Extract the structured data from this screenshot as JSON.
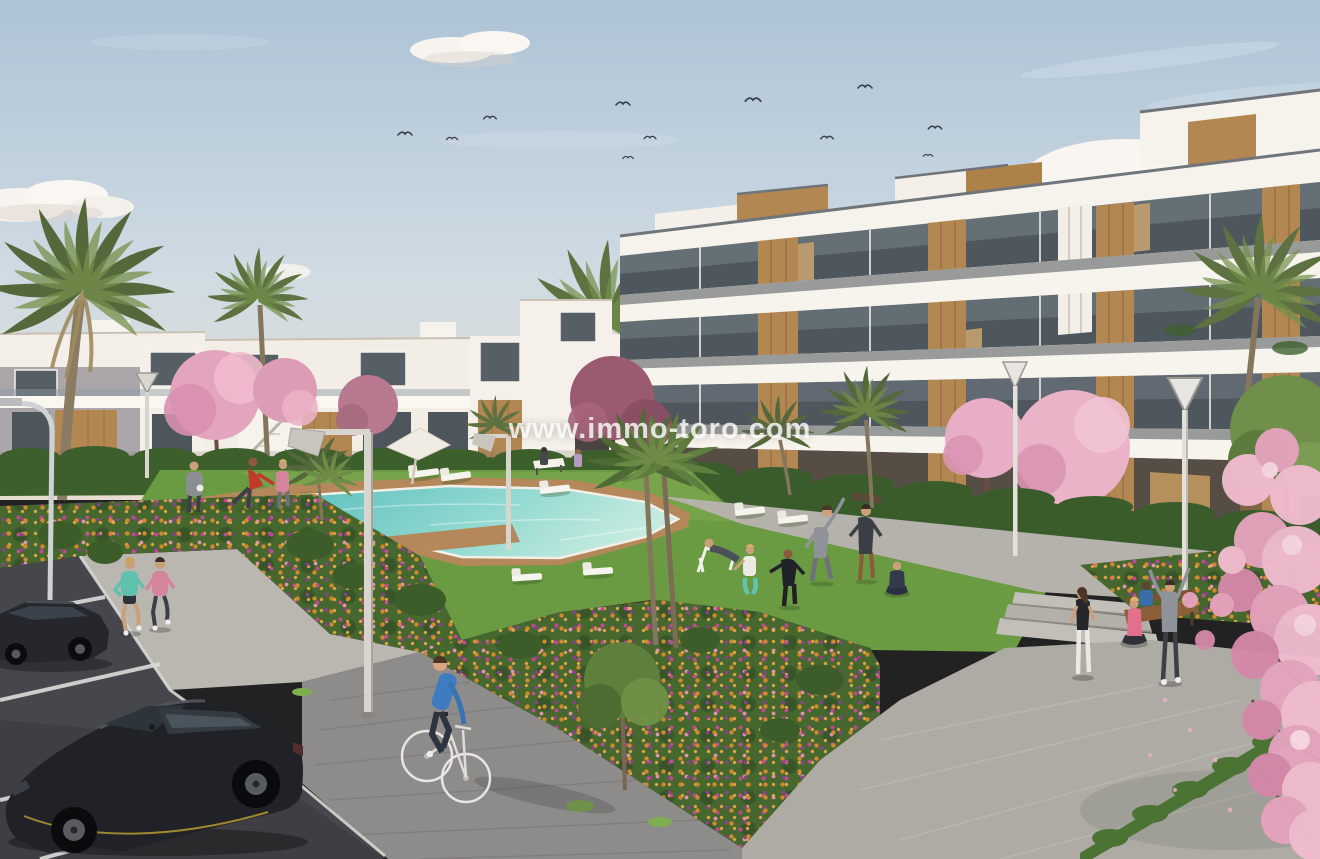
{
  "meta": {
    "type": "architectural-rendering",
    "subject": "New-build residential complex with communal pool, gardens and parking",
    "width": 1320,
    "height": 859
  },
  "watermark": {
    "text": "www.immo-toro.com",
    "color": "#ffffff",
    "opacity": 0.8
  },
  "palette": {
    "sky_top": "#adc3d6",
    "sky_horizon": "#e7ddd1",
    "cloud": "#f7f4f0",
    "building_white": "#f4f0e9",
    "building_shadow": "#d9d0c3",
    "wood_accent": "#b28751",
    "glass_dark": "#4e565e",
    "grass": "#6a9a42",
    "hedge": "#3d5f2c",
    "pool_water": "#7fd2cb",
    "pool_water_light": "#c6ebe0",
    "deck_wood": "#b4885a",
    "path_light": "#b6b3ad",
    "paver_dark": "#8e8b8b",
    "asphalt": "#46474c",
    "flower_orange": "#d3892e",
    "flower_magenta": "#c14a92",
    "flower_purple": "#8c3f95",
    "blossom_pink": "#eeb4ca",
    "car_black": "#212227",
    "shirt_blue": "#3d7cc0",
    "shirt_teal": "#5fc0ad",
    "shirt_pink": "#d4849c",
    "shirt_red": "#c0392b"
  },
  "scene": {
    "sky": {
      "elements": [
        "gradient sky",
        "clouds",
        "flock of birds"
      ],
      "bird_count": 11
    },
    "buildings": [
      {
        "name": "left terraced apartments",
        "floors": 2,
        "features": [
          "white facades",
          "wood panels",
          "external staircase",
          "arched doorway"
        ]
      },
      {
        "name": "right apartment block",
        "floors": 4,
        "features": [
          "sweeping white balconies",
          "wood panel accents",
          "glass railings",
          "rooftop volumes"
        ]
      }
    ],
    "pool": {
      "shape": "rectangular with side extension and cross deck",
      "deck": "wooden",
      "loungers": 9,
      "umbrellas": 1
    },
    "people": [
      {
        "label": "man stretching in red shirt",
        "x": 250,
        "y": 505
      },
      {
        "label": "man in gray with towel",
        "x": 195,
        "y": 510
      },
      {
        "label": "woman walking in pink top",
        "x": 283,
        "y": 508
      },
      {
        "label": "jogger woman in teal",
        "x": 131,
        "y": 632
      },
      {
        "label": "jogger woman in pink",
        "x": 160,
        "y": 630
      },
      {
        "label": "man reclining on deck chair",
        "x": 715,
        "y": 568
      },
      {
        "label": "woman squatting in teal leggings",
        "x": 750,
        "y": 590
      },
      {
        "label": "person in black tracksuit",
        "x": 790,
        "y": 602
      },
      {
        "label": "man stretching sideways in gray",
        "x": 822,
        "y": 578
      },
      {
        "label": "man standing in dark sportswear",
        "x": 866,
        "y": 576
      },
      {
        "label": "woman seated cross-legged doing yoga",
        "x": 897,
        "y": 592
      },
      {
        "label": "woman standing in black top and white leggings",
        "x": 1083,
        "y": 672
      },
      {
        "label": "woman seated cross-legged in pink top",
        "x": 1134,
        "y": 638
      },
      {
        "label": "person in gray hoodie with arms raised",
        "x": 1170,
        "y": 678
      },
      {
        "label": "cyclist in blue sweater on white bicycle",
        "x": 441,
        "y": 730
      },
      {
        "label": "two people seated on wooden bench",
        "x": 1160,
        "y": 615
      },
      {
        "label": "two pedestrians near white bench",
        "x": 550,
        "y": 458
      }
    ],
    "vehicles": [
      {
        "type": "hatchback car",
        "color": "black"
      },
      {
        "type": "sedan car",
        "color": "dark gray"
      },
      {
        "type": "bicycle",
        "color": "white"
      }
    ],
    "vegetation": [
      "palm trees",
      "cherry blossom trees",
      "flower beds",
      "hedges",
      "lawns",
      "green trees"
    ],
    "furniture": [
      "sun loungers",
      "parasol",
      "benches",
      "street lamps"
    ],
    "ground": [
      "wooden pool deck",
      "stone plaza",
      "paver path",
      "sidewalk",
      "asphalt parking with white bay lines",
      "concrete steps"
    ]
  }
}
